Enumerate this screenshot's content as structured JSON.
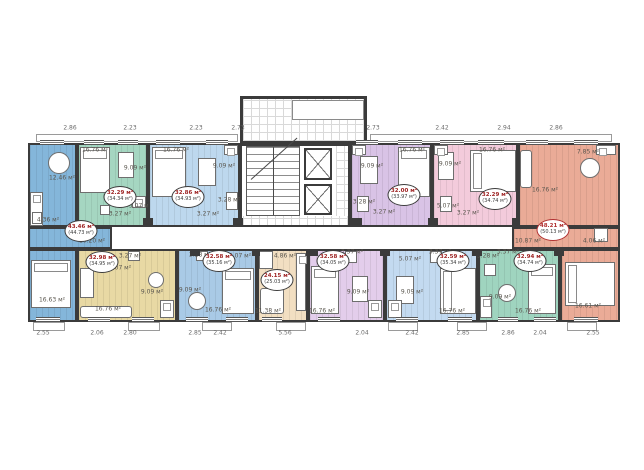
{
  "plan": {
    "unit_suffix": "м²",
    "wall_color": "#3b3b3b",
    "badge_value_color": "#9e2424",
    "dims_top_y": 128,
    "dims_bottom_y": 333,
    "dims_top": [
      [
        "2.86",
        70
      ],
      [
        "2.23",
        130
      ],
      [
        "2.23",
        196
      ],
      [
        "2.73",
        238
      ],
      [
        "2.73",
        373
      ],
      [
        "2.42",
        442
      ],
      [
        "2.94",
        504
      ],
      [
        "2.86",
        556
      ]
    ],
    "dims_bottom": [
      [
        "2.55",
        43
      ],
      [
        "2.06",
        97
      ],
      [
        "2.80",
        130
      ],
      [
        "2.85",
        195
      ],
      [
        "2.42",
        220
      ],
      [
        "5.56",
        285
      ],
      [
        "2.04",
        362
      ],
      [
        "2.42",
        412
      ],
      [
        "2.85",
        463
      ],
      [
        "2.86",
        508
      ],
      [
        "2.04",
        540
      ],
      [
        "2.55",
        593
      ]
    ],
    "base": [
      28,
      143,
      592,
      179
    ],
    "protrusion": [
      240,
      96,
      127,
      47
    ],
    "inner_box": [
      292,
      100,
      72,
      20
    ],
    "corridor": [
      112,
      227,
      402,
      22
    ],
    "core": {
      "room": [
        240,
        143,
        110,
        84
      ],
      "lobby": [
        [
          243,
          99,
          121,
          42
        ],
        [
          336,
          146,
          12,
          79
        ],
        [
          243,
          216,
          105,
          11
        ]
      ],
      "stairs": [
        246,
        146,
        54,
        70
      ],
      "elevators": [
        [
          304,
          148,
          28,
          32
        ],
        [
          304,
          184,
          28,
          31
        ]
      ]
    },
    "apartments": [
      {
        "id": "unit-1",
        "color": "#84b6da",
        "rects": [
          [
            28,
            143,
            49,
            84
          ],
          [
            28,
            227,
            84,
            22
          ],
          [
            28,
            249,
            49,
            73
          ]
        ],
        "badge": {
          "x": 81,
          "y": 231,
          "value": "43.46 м²",
          "total": "(44.73 м²)"
        },
        "rooms": [
          [
            "12.46 м²",
            62,
            178
          ],
          [
            "4.36 м²",
            48,
            220
          ],
          [
            "10.20 м²",
            92,
            241
          ],
          [
            "16.63 м²",
            52,
            300
          ]
        ],
        "furniture": [
          [
            "table-round",
            48,
            152,
            22,
            22
          ],
          [
            "counter",
            30,
            192,
            13,
            34
          ],
          [
            "wc",
            32,
            212,
            10,
            12
          ],
          [
            "bed-v",
            31,
            260,
            40,
            48
          ]
        ]
      },
      {
        "id": "unit-2",
        "color": "#a5d6c1",
        "rects": [
          [
            77,
            143,
            71,
            84
          ]
        ],
        "badge": {
          "x": 120,
          "y": 197,
          "value": "32.29 м²",
          "total": "(34.34 м²)"
        },
        "rooms": [
          [
            "16.76 м²",
            95,
            150
          ],
          [
            "9.09 м²",
            135,
            168
          ],
          [
            "5.07 м²",
            140,
            206
          ],
          [
            "3.27 м²",
            120,
            214
          ]
        ],
        "furniture": [
          [
            "bed-v",
            80,
            147,
            30,
            46
          ],
          [
            "table",
            118,
            152,
            16,
            26
          ],
          [
            "counter",
            132,
            196,
            14,
            12
          ],
          [
            "wc",
            100,
            205,
            10,
            10
          ]
        ]
      },
      {
        "id": "unit-3",
        "color": "#bdd8ee",
        "rects": [
          [
            148,
            143,
            92,
            84
          ]
        ],
        "badge": {
          "x": 188,
          "y": 197,
          "value": "32.86 м²",
          "total": "(34.93 м²)"
        },
        "rooms": [
          [
            "16.76 м²",
            176,
            150
          ],
          [
            "9.09 м²",
            224,
            166
          ],
          [
            "3.28 м²",
            229,
            200
          ],
          [
            "3.27 м²",
            208,
            214
          ]
        ],
        "furniture": [
          [
            "bed-v",
            152,
            147,
            34,
            50
          ],
          [
            "table",
            198,
            158,
            18,
            28
          ],
          [
            "counter",
            224,
            145,
            14,
            10
          ],
          [
            "wc",
            226,
            192,
            12,
            18
          ]
        ]
      },
      {
        "id": "unit-4",
        "color": "#d9c3e6",
        "rects": [
          [
            350,
            143,
            82,
            84
          ]
        ],
        "badge": {
          "x": 404,
          "y": 195,
          "value": "32.00 м²",
          "total": "(33.97 м²)"
        },
        "rooms": [
          [
            "9.09 м²",
            372,
            166
          ],
          [
            "16.76 м²",
            412,
            150
          ],
          [
            "3.28 м²",
            364,
            202
          ],
          [
            "3.27 м²",
            384,
            212
          ]
        ],
        "furniture": [
          [
            "table",
            360,
            156,
            18,
            28
          ],
          [
            "bed-v",
            398,
            147,
            32,
            50
          ],
          [
            "counter",
            352,
            145,
            14,
            10
          ],
          [
            "wc",
            357,
            196,
            12,
            16
          ]
        ]
      },
      {
        "id": "unit-5",
        "color": "#f3cbdb",
        "rects": [
          [
            432,
            143,
            86,
            84
          ]
        ],
        "badge": {
          "x": 495,
          "y": 199,
          "value": "32.29 м²",
          "total": "(34.74 м²)"
        },
        "rooms": [
          [
            "9.09 м²",
            450,
            164
          ],
          [
            "16.76 м²",
            492,
            150
          ],
          [
            "5.07 м²",
            448,
            206
          ],
          [
            "3.27 м²",
            468,
            213
          ]
        ],
        "furniture": [
          [
            "table",
            438,
            152,
            16,
            28
          ],
          [
            "bed-h",
            470,
            150,
            46,
            42
          ],
          [
            "counter",
            434,
            145,
            14,
            10
          ],
          [
            "wc",
            440,
            196,
            12,
            16
          ]
        ]
      },
      {
        "id": "unit-6",
        "color": "#eaab97",
        "rects": [
          [
            518,
            143,
            102,
            84
          ],
          [
            512,
            227,
            108,
            22
          ],
          [
            560,
            249,
            60,
            73
          ]
        ],
        "badge": {
          "x": 553,
          "y": 230,
          "value": "48.21 м²",
          "total": "(50.13 м²)",
          "accent": "#b03030"
        },
        "rooms": [
          [
            "16.76 м²",
            545,
            190
          ],
          [
            "7.85 м²",
            588,
            152
          ],
          [
            "10.87 м²",
            528,
            241
          ],
          [
            "4.06 м²",
            594,
            241
          ],
          [
            "16.61 м²",
            588,
            306
          ]
        ],
        "furniture": [
          [
            "sofa",
            520,
            150,
            12,
            38
          ],
          [
            "table-round",
            580,
            158,
            20,
            20
          ],
          [
            "counter",
            596,
            145,
            20,
            10
          ],
          [
            "bed-h",
            565,
            262,
            50,
            44
          ],
          [
            "wc",
            594,
            228,
            14,
            14
          ]
        ]
      },
      {
        "id": "unit-7",
        "color": "#e8d9a4",
        "rects": [
          [
            77,
            249,
            100,
            73
          ]
        ],
        "badge": {
          "x": 102,
          "y": 262,
          "value": "32.98 м²",
          "total": "(34.95 м²)"
        },
        "rooms": [
          [
            "3.27 м²",
            130,
            256
          ],
          [
            "5.07 м²",
            120,
            268
          ],
          [
            "9.09 м²",
            152,
            292
          ],
          [
            "16.76 м²",
            108,
            309
          ]
        ],
        "furniture": [
          [
            "wardrobe",
            80,
            268,
            14,
            30
          ],
          [
            "sofa",
            80,
            306,
            52,
            12
          ],
          [
            "table-round",
            148,
            272,
            16,
            16
          ],
          [
            "counter",
            160,
            300,
            14,
            18
          ],
          [
            "wc",
            128,
            251,
            12,
            10
          ]
        ]
      },
      {
        "id": "unit-8",
        "color": "#a9cae6",
        "rects": [
          [
            177,
            249,
            80,
            73
          ]
        ],
        "badge": {
          "x": 219,
          "y": 261,
          "value": "32.58 м²",
          "total": "(35.16 м²)"
        },
        "rooms": [
          [
            "3.28 м²",
            200,
            255
          ],
          [
            "5.07 м²",
            240,
            256
          ],
          [
            "9.09 м²",
            190,
            290
          ],
          [
            "16.76 м²",
            218,
            310
          ]
        ],
        "furniture": [
          [
            "table-round",
            188,
            292,
            18,
            18
          ],
          [
            "bed-v",
            222,
            268,
            32,
            46
          ],
          [
            "wc",
            196,
            251,
            12,
            10
          ]
        ]
      },
      {
        "id": "unit-9",
        "color": "#f2dfc2",
        "rects": [
          [
            257,
            249,
            51,
            73
          ]
        ],
        "badge": {
          "x": 277,
          "y": 280,
          "value": "24.15 м²",
          "total": "(25.03 м²)"
        },
        "rooms": [
          [
            "4.86 м²",
            285,
            256
          ],
          [
            "11.38 м²",
            268,
            311
          ]
        ],
        "furniture": [
          [
            "wc",
            259,
            251,
            14,
            18
          ],
          [
            "counter",
            296,
            253,
            10,
            58
          ],
          [
            "sofa",
            260,
            288,
            24,
            26
          ]
        ]
      },
      {
        "id": "unit-10",
        "color": "#e3cdeb",
        "rects": [
          [
            308,
            249,
            77,
            73
          ]
        ],
        "badge": {
          "x": 333,
          "y": 261,
          "value": "32.58 м²",
          "total": "(34.05 м²)"
        },
        "rooms": [
          [
            "3.37 м²",
            352,
            252
          ],
          [
            "9.09 м²",
            358,
            292
          ],
          [
            "16.76 м²",
            322,
            311
          ]
        ],
        "furniture": [
          [
            "bed-v",
            311,
            266,
            28,
            48
          ],
          [
            "table",
            352,
            276,
            16,
            26
          ],
          [
            "wc",
            345,
            251,
            12,
            12
          ],
          [
            "counter",
            368,
            300,
            14,
            18
          ]
        ]
      },
      {
        "id": "unit-11",
        "color": "#c3daf0",
        "rects": [
          [
            385,
            249,
            93,
            73
          ]
        ],
        "badge": {
          "x": 453,
          "y": 261,
          "value": "32.59 м²",
          "total": "(35.34 м²)"
        },
        "rooms": [
          [
            "5.07 м²",
            410,
            259
          ],
          [
            "3.37 м²",
            440,
            252
          ],
          [
            "9.09 м²",
            412,
            292
          ],
          [
            "16.76 м²",
            452,
            311
          ]
        ],
        "furniture": [
          [
            "table",
            396,
            276,
            18,
            28
          ],
          [
            "bed-h",
            440,
            268,
            36,
            46
          ],
          [
            "wc",
            430,
            251,
            12,
            12
          ],
          [
            "counter",
            388,
            300,
            14,
            18
          ]
        ]
      },
      {
        "id": "unit-12",
        "color": "#9fd4bf",
        "rects": [
          [
            478,
            249,
            82,
            73
          ]
        ],
        "badge": {
          "x": 530,
          "y": 261,
          "value": "32.94 м²",
          "total": "(34.74 м²)"
        },
        "rooms": [
          [
            "3.28 м²",
            488,
            256
          ],
          [
            "3.37 м²",
            508,
            252
          ],
          [
            "9.09 м²",
            500,
            297
          ],
          [
            "16.76 м²",
            528,
            311
          ]
        ],
        "furniture": [
          [
            "table-round",
            498,
            284,
            18,
            18
          ],
          [
            "bed-v",
            528,
            264,
            28,
            50
          ],
          [
            "wc",
            484,
            264,
            12,
            12
          ],
          [
            "counter",
            480,
            296,
            12,
            22
          ]
        ]
      }
    ],
    "shafts": [
      [
        143,
        218,
        10,
        8
      ],
      [
        233,
        218,
        10,
        8
      ],
      [
        352,
        218,
        10,
        8
      ],
      [
        428,
        218,
        10,
        8
      ],
      [
        512,
        218,
        8,
        8
      ],
      [
        190,
        249,
        10,
        7
      ],
      [
        252,
        249,
        8,
        7
      ],
      [
        308,
        249,
        10,
        7
      ],
      [
        380,
        249,
        10,
        7
      ],
      [
        472,
        249,
        10,
        7
      ],
      [
        554,
        249,
        10,
        7
      ]
    ],
    "windows_top": {
      "y": 140,
      "h": 5,
      "spans": [
        [
          40,
          24
        ],
        [
          84,
          20
        ],
        [
          118,
          20
        ],
        [
          156,
          24
        ],
        [
          206,
          22
        ],
        [
          356,
          22
        ],
        [
          398,
          24
        ],
        [
          440,
          24
        ],
        [
          478,
          26
        ],
        [
          526,
          22
        ],
        [
          574,
          24
        ]
      ]
    },
    "windows_bottom": {
      "y": 317,
      "h": 5,
      "spans": [
        [
          36,
          24
        ],
        [
          88,
          22
        ],
        [
          132,
          22
        ],
        [
          186,
          22
        ],
        [
          226,
          22
        ],
        [
          262,
          20
        ],
        [
          318,
          22
        ],
        [
          396,
          22
        ],
        [
          448,
          24
        ],
        [
          498,
          20
        ],
        [
          534,
          22
        ],
        [
          574,
          24
        ]
      ]
    },
    "balconies_top": [
      [
        36,
        134,
        202,
        8
      ],
      [
        370,
        134,
        242,
        8
      ]
    ],
    "balconies_bottom": [
      [
        33,
        322,
        32,
        9
      ],
      [
        128,
        322,
        32,
        9
      ],
      [
        202,
        322,
        30,
        9
      ],
      [
        276,
        322,
        30,
        9
      ],
      [
        388,
        322,
        30,
        9
      ],
      [
        457,
        322,
        30,
        9
      ],
      [
        567,
        322,
        30,
        9
      ]
    ]
  }
}
